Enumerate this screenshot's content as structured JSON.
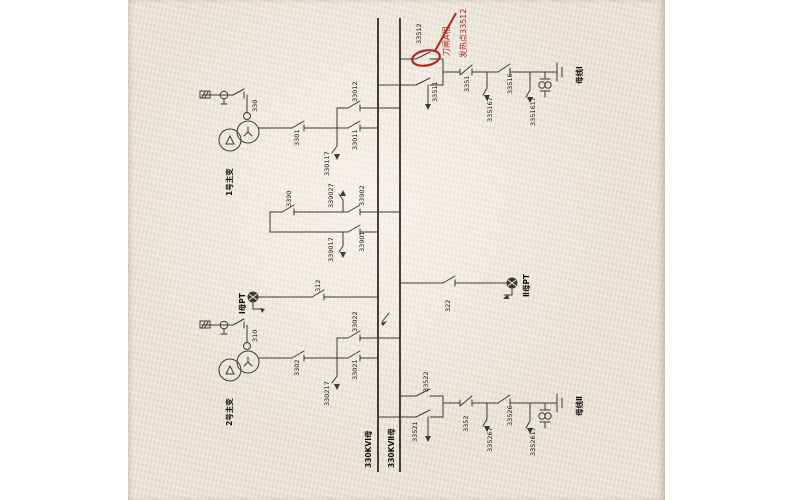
{
  "photo": {
    "description": "Photographed single-line diagram of a 330kV substation, rotated 90 degrees, with red inspection annotation",
    "paper_color": "#e9e2d4",
    "line_color": "#3b3b3b",
    "annotation_color": "#b3271d"
  },
  "buses": {
    "bus1_label": "330KVⅠ母",
    "bus2_label": "330KVⅡ母"
  },
  "line_bay_top": {
    "disc_bus2": "33512",
    "disc_bus1": "33511",
    "breaker": "3351",
    "earth_a": "335167",
    "disc_line": "33516",
    "earth_b": "3351617",
    "line_label": "母线Ⅰ"
  },
  "transformer_bay_top": {
    "neutral_switch": "330",
    "breaker": "3301",
    "disc_bus1": "33011",
    "disc_bus2": "33012",
    "earth": "330117",
    "name": "1号主变"
  },
  "pt_bay_mid": {
    "switch": "3390",
    "disc_bus2": "33902",
    "earth_top": "339027",
    "disc_bus1": "33901",
    "earth_bottom": "339017"
  },
  "bus_pt_row": {
    "pt1_label": "Ⅰ母PT",
    "switch_bus1": "312",
    "switch_bus2": "322",
    "pt2_label": "Ⅱ母PT"
  },
  "transformer_bay_bottom": {
    "neutral_switch": "310",
    "breaker": "3302",
    "disc_bus1": "33021",
    "disc_bus2": "33022",
    "earth": "330217",
    "name": "2号主变"
  },
  "line_bay_bottom": {
    "disc_bus2": "33522",
    "disc_bus1": "33521",
    "breaker": "3352",
    "earth_a": "335267",
    "disc_line": "33526",
    "earth_b": "3352617",
    "line_label": "母线Ⅱ"
  },
  "annotation": {
    "line1": "发热点33512",
    "line2": "刀闸A相"
  }
}
